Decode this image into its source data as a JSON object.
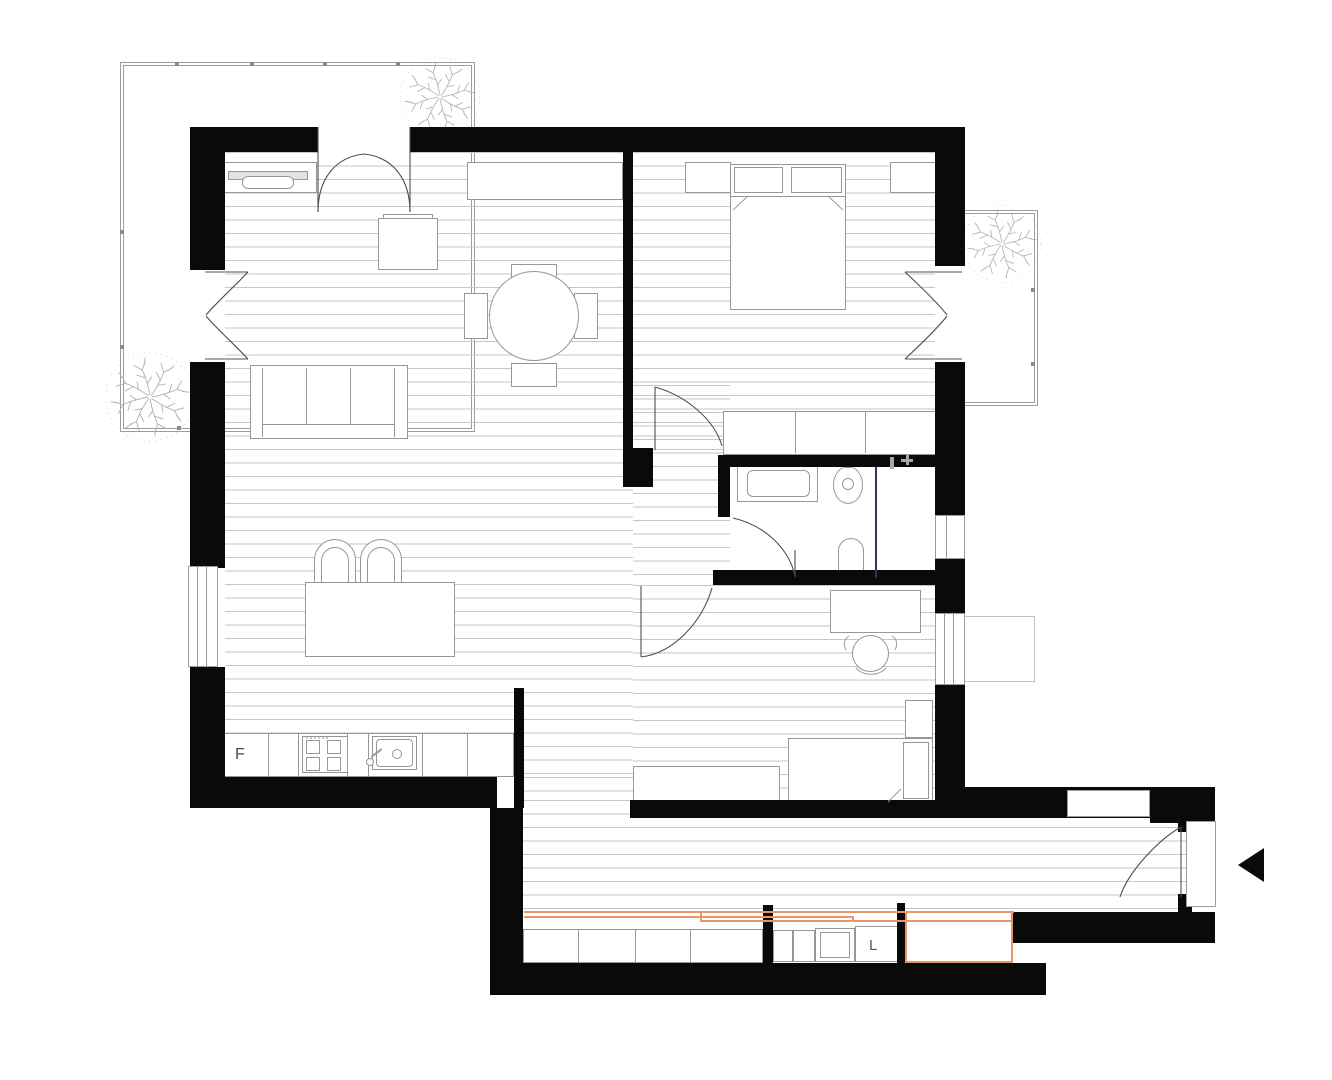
{
  "title": "apartment-floor-plan",
  "labels": {
    "fridge": "F",
    "laundry": "L"
  },
  "colors": {
    "wall": "#0a0a0a",
    "floor_line": "#c6c6c6",
    "furniture_line": "#979797",
    "accent_sliding_door": "#e8956a",
    "shower_partition": "#2b3a52"
  },
  "rooms": [
    {
      "name": "living-kitchen"
    },
    {
      "name": "bedroom-main"
    },
    {
      "name": "bedroom-second"
    },
    {
      "name": "bathroom"
    },
    {
      "name": "hallway"
    },
    {
      "name": "corridor"
    },
    {
      "name": "balcony-top-left"
    },
    {
      "name": "balcony-right"
    }
  ],
  "entrance": {
    "arrow_direction": "left"
  }
}
